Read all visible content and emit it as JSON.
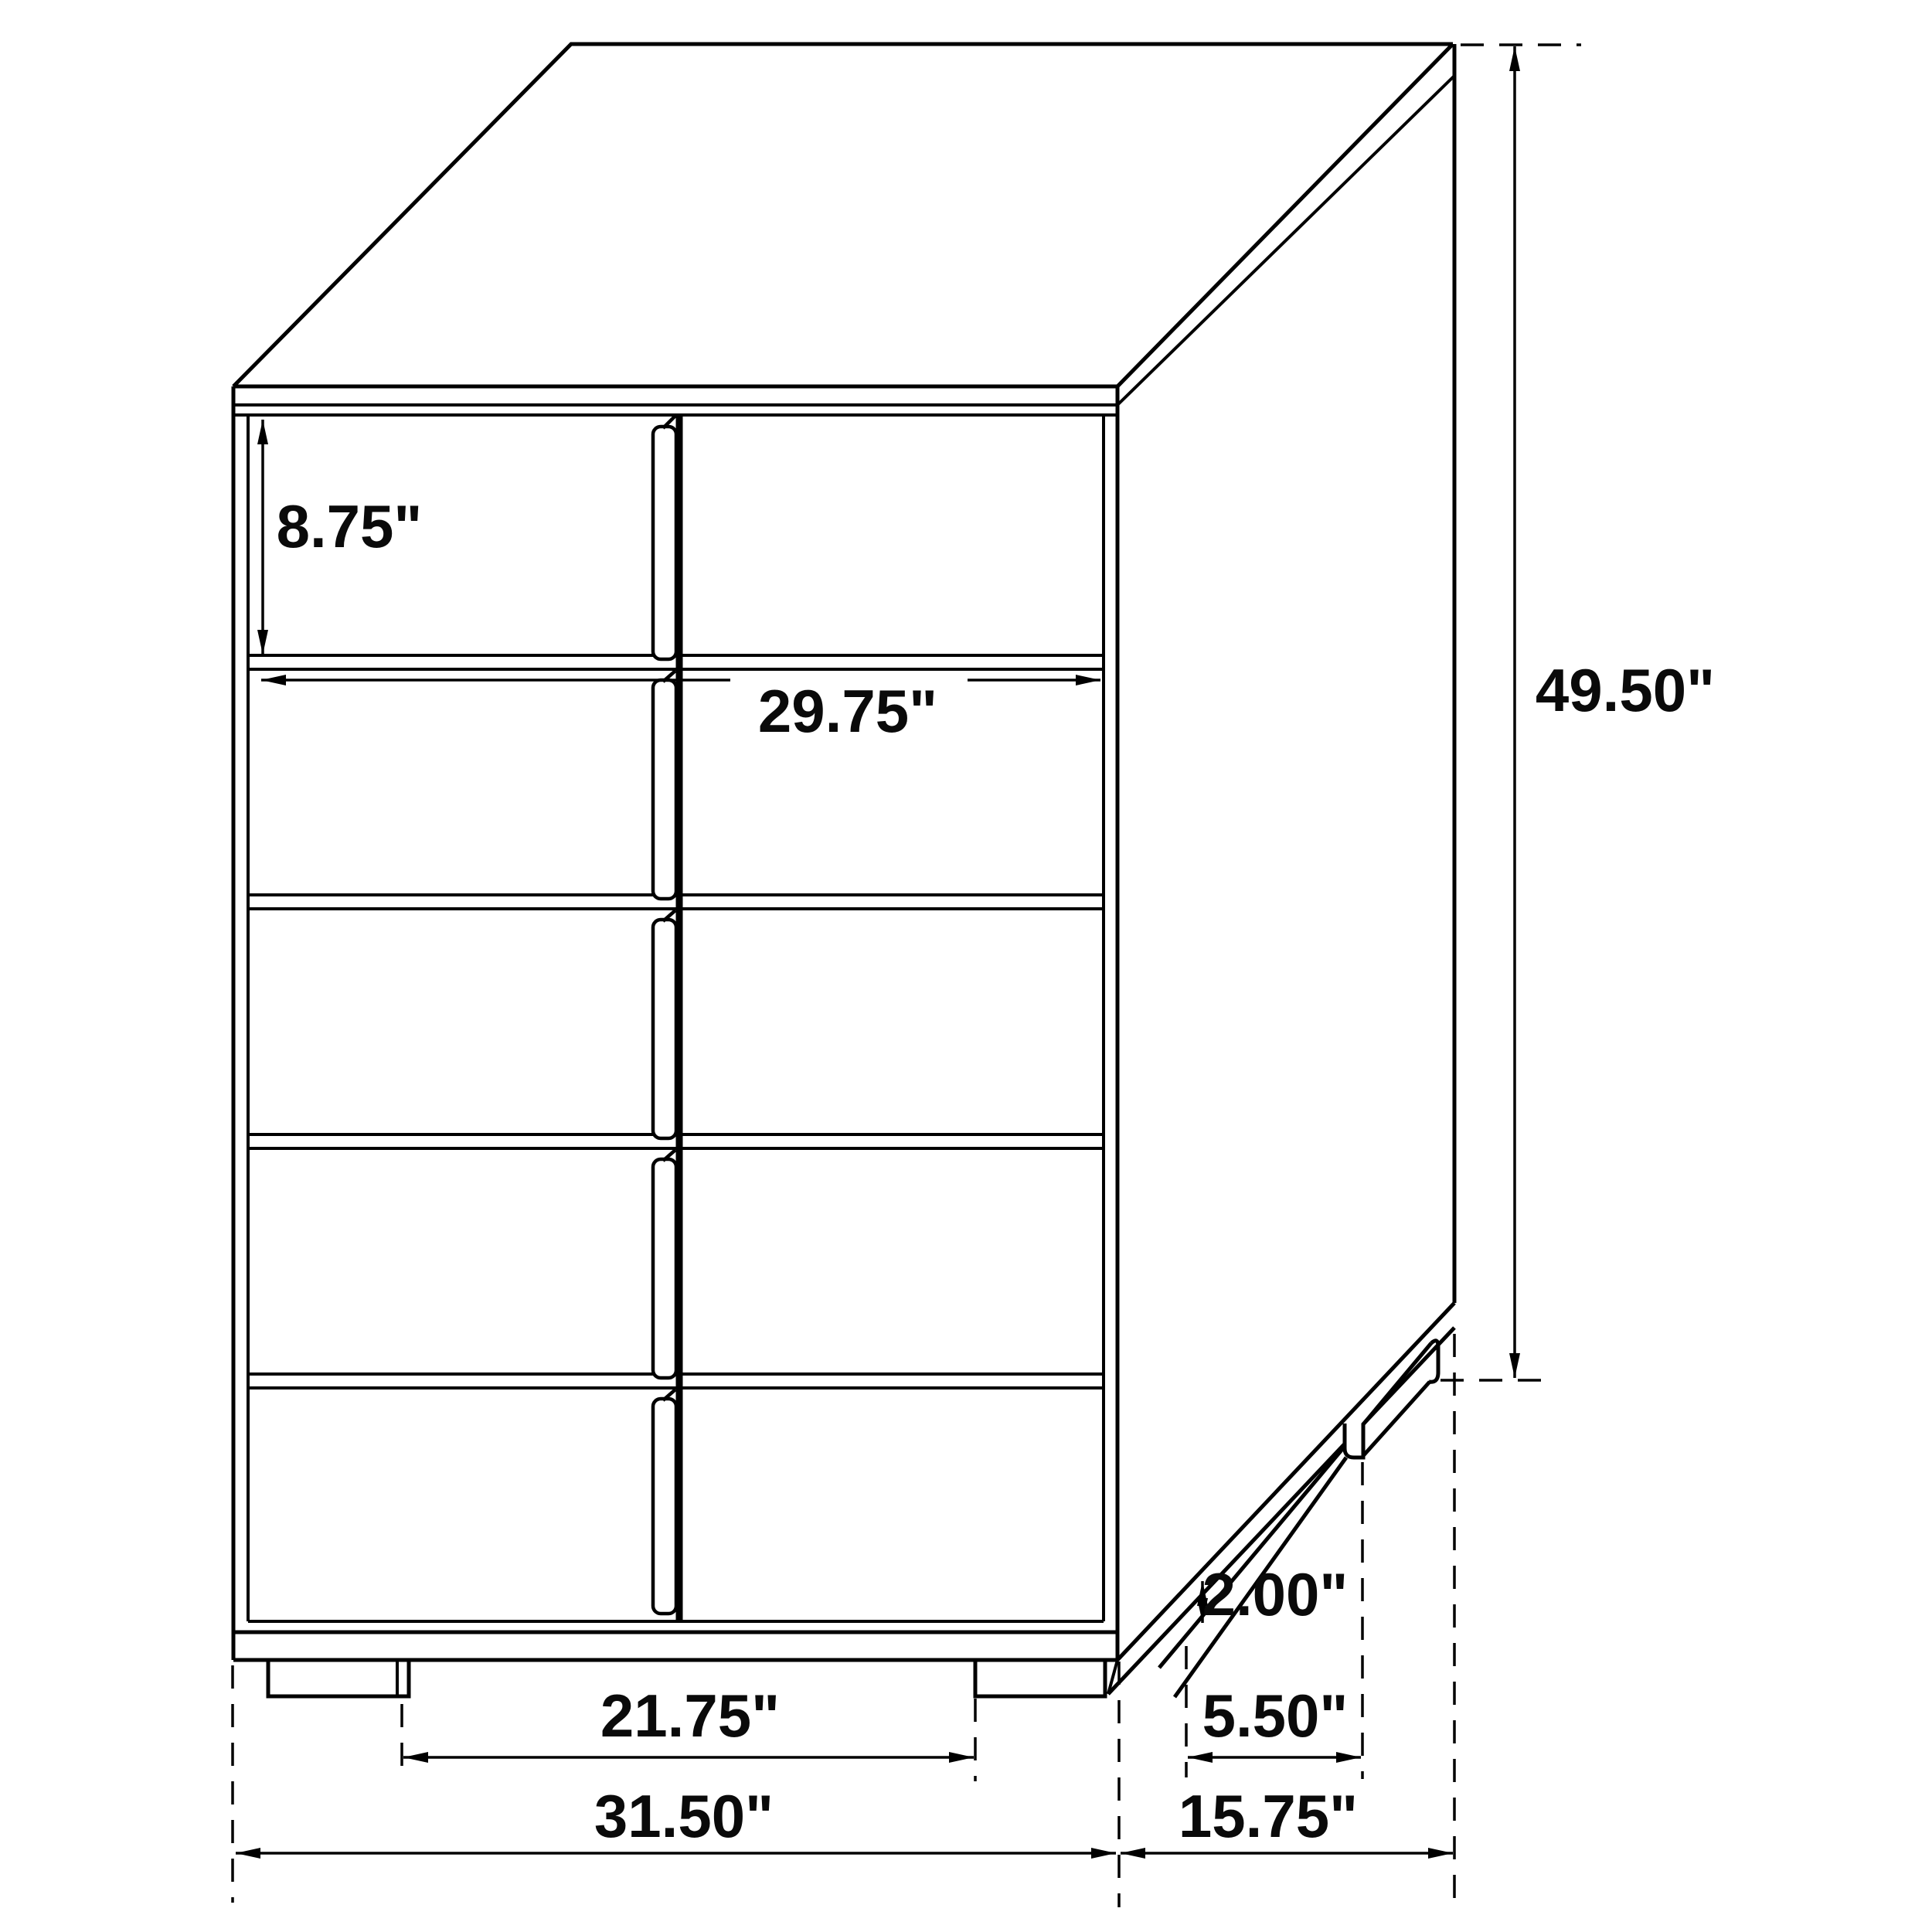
{
  "labels": {
    "drawer_height": "8.75\"",
    "drawer_width": "29.75\"",
    "overall_height": "49.50\"",
    "foot_height": "2.00\"",
    "foot_depth_spacing": "5.50\"",
    "foot_width_spacing": "21.75\"",
    "overall_width": "31.50\"",
    "overall_depth": "15.75\""
  }
}
